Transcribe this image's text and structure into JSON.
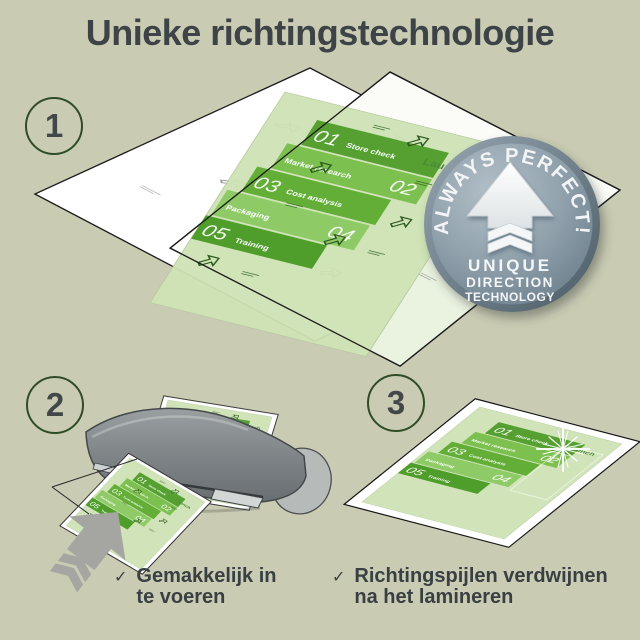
{
  "title": "Unieke richtingstechnologie",
  "steps": {
    "one": "1",
    "two": "2",
    "three": "3"
  },
  "badge": {
    "arc_text": "ALWAYS PERFECT!",
    "lines": [
      "UNIQUE",
      "DIRECTION",
      "TECHNOLOGY"
    ]
  },
  "document": {
    "launch": "Launch",
    "items": [
      {
        "num": "01",
        "label": "Store check"
      },
      {
        "num": "02",
        "label": "Market research"
      },
      {
        "num": "03",
        "label": "Cost analysis"
      },
      {
        "num": "04",
        "label": "Packaging"
      },
      {
        "num": "05",
        "label": "Training"
      }
    ]
  },
  "checklist": [
    {
      "line1": "Gemakkelijk in",
      "line2": "te voeren"
    },
    {
      "line1": "Richtingspijlen verdwijnen",
      "line2": "na het lamineren"
    }
  ],
  "checkmark": "✓",
  "colors": {
    "background": "#c9cbb3",
    "title_text": "#3d4347",
    "step_circle_border": "#2e4d24",
    "badge_face": "#8da0ac",
    "badge_rim": "#5d707c",
    "doc_background": "#cfe3b5",
    "doc_green_dark": "#55a030",
    "doc_green_mid": "#63ae37",
    "doc_green_light": "#8ecb66",
    "machine_gray": "#82888a"
  }
}
